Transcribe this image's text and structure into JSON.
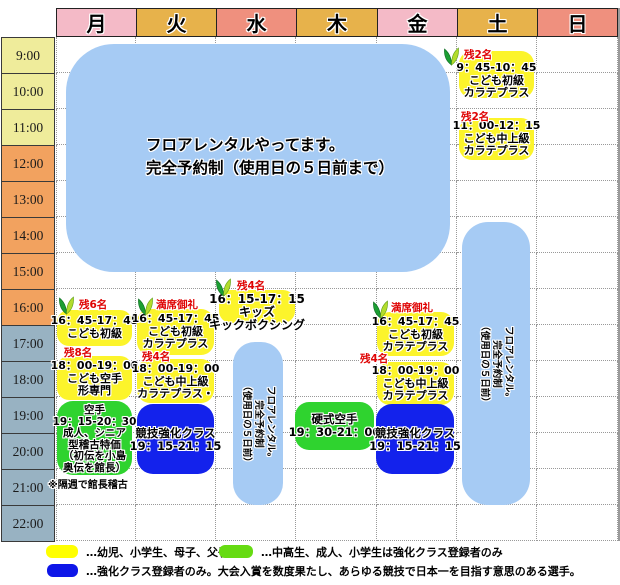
{
  "palette": {
    "yellow": "#FCF42B",
    "green": "#2FD32F",
    "blue": "#1322EC",
    "light_blue": "#A6CBF4",
    "red": "#DF0404"
  },
  "icons": {
    "sprout": "young-leaves-beginner-mark"
  },
  "days": [
    {
      "label": "月",
      "color": "#F4BAC7"
    },
    {
      "label": "火",
      "color": "#E7B24B"
    },
    {
      "label": "水",
      "color": "#EF907E"
    },
    {
      "label": "木",
      "color": "#E7B24B"
    },
    {
      "label": "金",
      "color": "#F4BAC7"
    },
    {
      "label": "土",
      "color": "#E7B24B"
    },
    {
      "label": "日",
      "color": "#EF907E"
    }
  ],
  "times": [
    {
      "label": "9:00",
      "color": "#EFEC9B"
    },
    {
      "label": "10:00",
      "color": "#EFEC9B"
    },
    {
      "label": "11:00",
      "color": "#EFEC9B"
    },
    {
      "label": "12:00",
      "color": "#F2A25F"
    },
    {
      "label": "13:00",
      "color": "#F2A25F"
    },
    {
      "label": "14:00",
      "color": "#F2A25F"
    },
    {
      "label": "15:00",
      "color": "#F2A25F"
    },
    {
      "label": "16:00",
      "color": "#F2A25F"
    },
    {
      "label": "17:00",
      "color": "#98B2C2"
    },
    {
      "label": "18:00",
      "color": "#98B2C2"
    },
    {
      "label": "19:00",
      "color": "#98B2C2"
    },
    {
      "label": "20:00",
      "color": "#98B2C2"
    },
    {
      "label": "21:00",
      "color": "#98B2C2"
    },
    {
      "label": "22:00",
      "color": "#98B2C2"
    }
  ],
  "main_notice": {
    "l1": "フロアレンタルやってます。",
    "l2": "完全予約制（使用日の５日前まで）"
  },
  "rental_vertical": {
    "l1": "フロアレンタル。",
    "l2": "完全予約制",
    "l3": "（使用日の５日前）"
  },
  "events": {
    "mon_kids_beginner": {
      "badge": "残6名",
      "l1": "16：45-17：45",
      "l2": "こども初級"
    },
    "mon_kids_kata": {
      "badge": "残8名",
      "l1": "18：00-19：00",
      "l2": "こども空手",
      "l3": "形専門"
    },
    "mon_karate_adult": {
      "l1": "空手",
      "l2": "19：15-20：30",
      "l3": "成人、シニア",
      "l4": "型稽古特価",
      "l5": "（初伝を小島",
      "l6": "奥伝を館長）"
    },
    "mon_footnote": "※隔週で館長稽古",
    "tue_kids_beginner": {
      "badge": "満席御礼",
      "l1": "16：45-17：45",
      "l2": "こども初級",
      "l3": "カラテプラス"
    },
    "tue_kids_mid": {
      "badge": "残4名",
      "l1": "18：00-19：00",
      "l2": "こども中上級",
      "l3": "カラテプラス・"
    },
    "tue_kyogi": {
      "l1": "競技強化クラス",
      "l2": "19：15-21：15"
    },
    "wed_kids_kick": {
      "badge": "残4名",
      "l1": "16：15-17：15",
      "l2": "キッズ",
      "l3": "キックボクシング"
    },
    "thu_koshiki": {
      "l1": "硬式空手",
      "l2": "19：30-21：00"
    },
    "fri_kids_beginner": {
      "badge": "満席御礼",
      "l1": "16：45-17：45",
      "l2": "こども初級",
      "l3": "カラテプラス"
    },
    "fri_kids_mid": {
      "badge": "残4名",
      "l1": "18：00-19：00",
      "l2": "こども中上級",
      "l3": "カラテプラス"
    },
    "fri_kyogi": {
      "l1": "競技強化クラス",
      "l2": "19：15-21：15"
    },
    "sat_kids_beginner": {
      "badge": "残2名",
      "l1": "9：45-10：45",
      "l2": "こども初級",
      "l3": "カラテプラス"
    },
    "sat_kids_mid": {
      "badge": "残2名",
      "l1": "11：00-12：15",
      "l2": "こども中上級",
      "l3": "カラテプラス"
    }
  },
  "legend": {
    "yellow": {
      "color": "#FFFF00",
      "text": "…幼児、小学生、母子、父子"
    },
    "green": {
      "color": "#66DB12",
      "text": "…中高生、成人、小学生は強化クラス登録者のみ"
    },
    "blue": {
      "color": "#0E16E8",
      "text": "…強化クラス登録者のみ。大会入賞を数度果たし、あらゆる競技で日本一を目指す意思のある選手。"
    }
  }
}
